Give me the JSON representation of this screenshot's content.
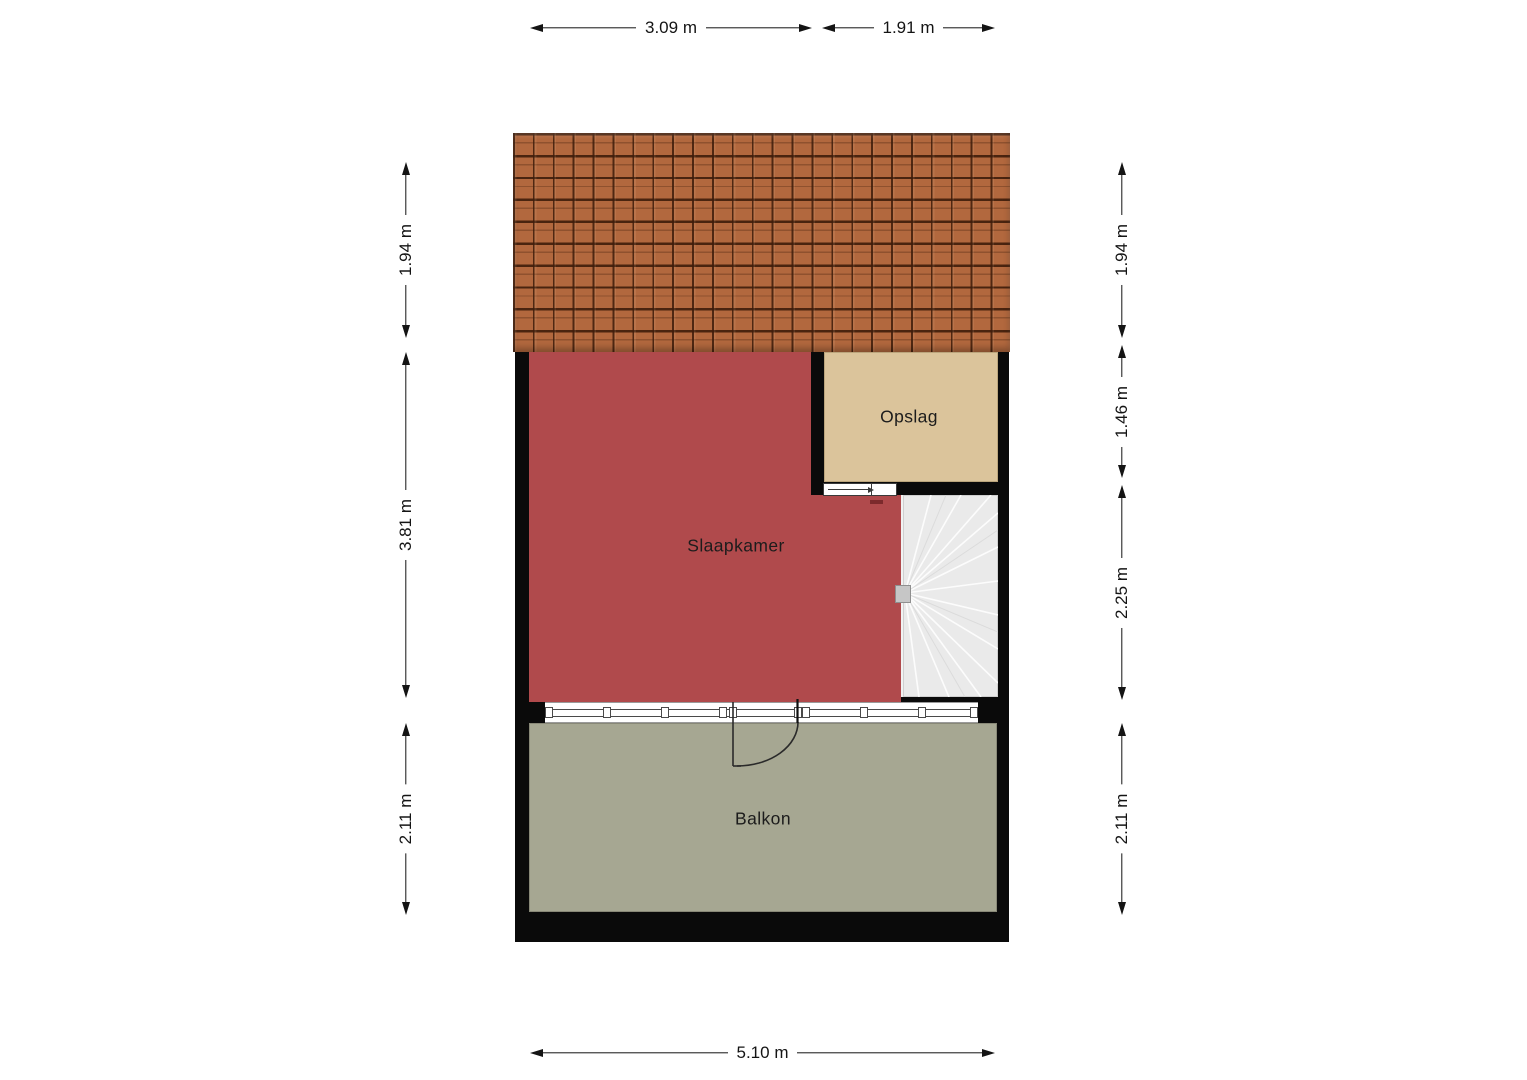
{
  "plan": {
    "type": "floorplan",
    "rooms": [
      {
        "label": "Slaapkamer",
        "color": "#b04a4c"
      },
      {
        "label": "Opslag",
        "color": "#dbc49b"
      },
      {
        "label": "Balkon",
        "color": "#a6a792"
      }
    ],
    "features": {
      "roof": "tiled-roof",
      "stairs": "winder-staircase",
      "balcony_door": "swing-door",
      "storage_door": "sliding-door",
      "window_band": "glazing-with-mullions"
    },
    "colors": {
      "wall": "#0a0a0a",
      "roof_tile": "#b2683e",
      "roof_joint": "#3e1c0a",
      "bedroom": "#b04a4c",
      "storage": "#dbc49b",
      "balcony": "#a6a792",
      "stairs": "#eaeaea",
      "background": "#ffffff",
      "dimension_ink": "#141414"
    }
  },
  "dimensions": {
    "top": [
      {
        "label": "3.09 m"
      },
      {
        "label": "1.91 m"
      }
    ],
    "bottom": [
      {
        "label": "5.10 m"
      }
    ],
    "left": [
      {
        "label": "1.94 m"
      },
      {
        "label": "3.81 m"
      },
      {
        "label": "2.11 m"
      }
    ],
    "right": [
      {
        "label": "1.94 m"
      },
      {
        "label": "1.46 m"
      },
      {
        "label": "2.25 m"
      },
      {
        "label": "2.11 m"
      }
    ]
  }
}
